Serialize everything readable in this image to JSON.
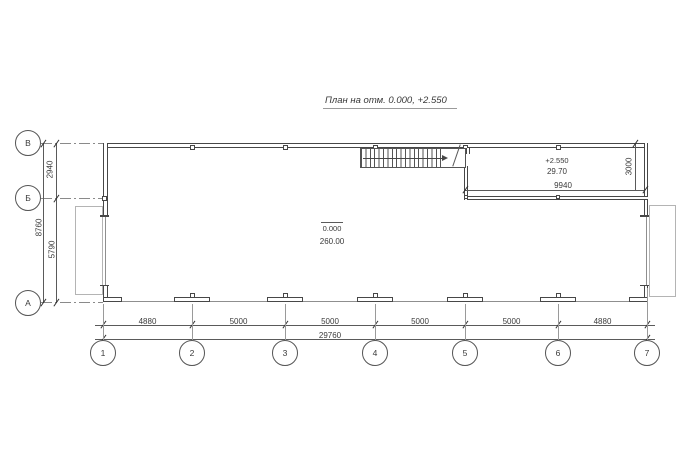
{
  "title": "План на отм. 0.000, +2.550",
  "axes": {
    "rows": [
      "В",
      "Б",
      "А"
    ],
    "cols": [
      "1",
      "2",
      "3",
      "4",
      "5",
      "6",
      "7"
    ]
  },
  "dimensions": {
    "left_segments": [
      "2940",
      "5790"
    ],
    "left_total": "8760",
    "bottom_segments": [
      "4880",
      "5000",
      "5000",
      "5000",
      "5000",
      "4880"
    ],
    "bottom_total": "29760",
    "mezzanine_width": "9940",
    "mezzanine_depth": "3000"
  },
  "labels": {
    "mezzanine_level": "+2.550",
    "mezzanine_area": "29.70",
    "hall_level": "0.000",
    "hall_area": "260.00"
  },
  "colors": {
    "line": "#474747",
    "dim_line": "#5a5a5a",
    "axis_line": "#8a8a8a",
    "platform": "#b4b4b4",
    "background": "#ffffff"
  }
}
